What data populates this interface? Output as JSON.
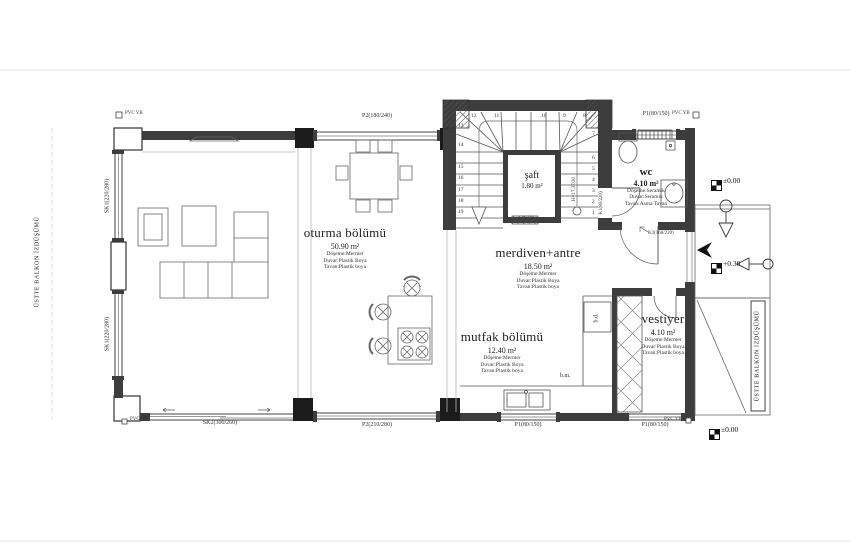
{
  "plan": {
    "rooms": {
      "oturma": {
        "name": "oturma bölümü",
        "area": "50.90 m²",
        "floor": "Döşeme:Mermer",
        "wall": "Duvar:Plastik Boya",
        "ceiling": "Tavan:Plastik boya"
      },
      "merdiven": {
        "name": "merdiven+antre",
        "area": "18.50 m²",
        "floor": "Döşeme:Mermer",
        "wall": "Duvar:Plastik Boya",
        "ceiling": "Tavan:Plastik boya"
      },
      "mutfak": {
        "name": "mutfak bölümü",
        "area": "12.40 m²",
        "floor": "Döşeme:Mermer",
        "wall": "Duvar:Plastik Boya",
        "ceiling": "Tavan:Plastik boya"
      },
      "saft": {
        "name": "şaft",
        "area": "1.80 m²"
      },
      "wc": {
        "name": "wc",
        "area": "4.10 m²",
        "floor": "Döşeme:Seramik",
        "wall": "Duvar:Seramik",
        "ceiling": "Tavan:Asma Tavan"
      },
      "vestiyer": {
        "name": "vestiyer",
        "area": "4.10 m²",
        "floor": "Döşeme:Mermer",
        "wall": "Duvar:Plastik Boya",
        "ceiling": "Tavan:Plastik boya"
      }
    },
    "openings": {
      "p2_top": "P2(180/240)",
      "p1_top": "P1(80/150)",
      "sk1_upper": "SK1(220/280)",
      "sk1_lower": "SK1(220/280)",
      "sk2_bottom": "SK2(300/260)",
      "p2_bottom": "P2(210/280)",
      "p1_bottom_kitchen": "P1(80/150)",
      "p1_bottom_vestiyer": "P1(80/150)",
      "k1_door": "K1(80/220)",
      "k3_door": "K3(160/220)",
      "saft_vent": "120/220"
    },
    "markers": {
      "pvc_tl": "PVC YB",
      "pvc_tr": "PVC YB",
      "pvc_bl": "PVC YB",
      "pvc_br": "PVC YB",
      "elev_entry": "±0.00",
      "elev_porch": "+0.30",
      "elev_ground": "±0.00"
    },
    "stairs": {
      "numbers": [
        "1",
        "2",
        "3",
        "4",
        "5",
        "6",
        "7",
        "8",
        "9",
        "10",
        "11",
        "12",
        "13",
        "14",
        "15",
        "16",
        "17",
        "18",
        "19"
      ],
      "note": "H=17,37/30"
    },
    "annotations": {
      "balkon_left": "ÜSTTE BALKON İZDÜŞÜMÜ",
      "balkon_right": "ÜSTTE BALKON İZDÜŞÜMÜ",
      "dishwasher": "b.m.",
      "fridge": "b.d."
    },
    "colors": {
      "line": "#3d3d3d",
      "column": "#1b1b1b",
      "light": "#e0e0e0"
    }
  }
}
